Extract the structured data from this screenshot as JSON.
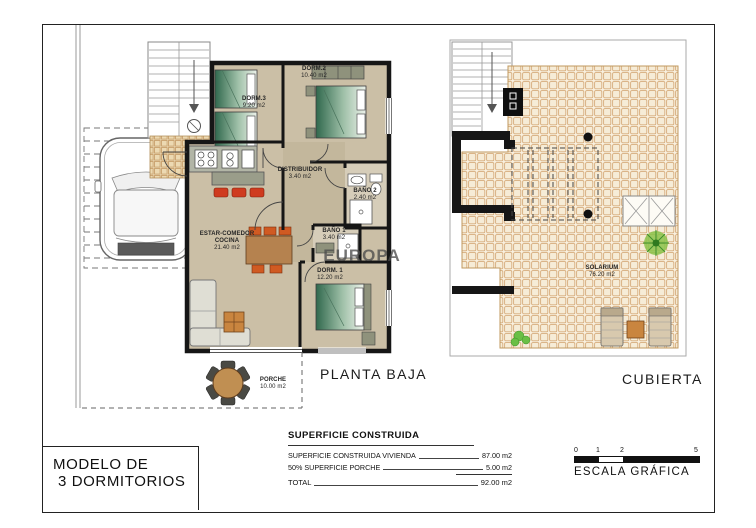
{
  "title_block": {
    "line1": "MODELO DE",
    "line2": "3 DORMITORIOS"
  },
  "watermark": "EUROPA",
  "plans": {
    "planta_baja": {
      "label": "PLANTA BAJA",
      "rooms": {
        "dorm3": {
          "name": "DORM.3",
          "area": "9.20 m2"
        },
        "dorm2": {
          "name": "DORM.2",
          "area": "10.40 m2"
        },
        "distribuidor": {
          "name": "DISTRIBUIDOR",
          "area": "3.40 m2"
        },
        "bano2": {
          "name": "BAÑO 2",
          "area": "2.40 m2"
        },
        "bano1": {
          "name": "BAÑO 1",
          "area": "3.40 m2"
        },
        "estar": {
          "name": "ESTAR-COMEDOR COCINA",
          "area": "21.40 m2"
        },
        "dorm1": {
          "name": "DORM. 1",
          "area": "12.20 m2"
        },
        "porche": {
          "name": "PORCHE",
          "area": "10.00 m2"
        }
      }
    },
    "cubierta": {
      "label": "CUBIERTA",
      "rooms": {
        "solarium": {
          "name": "SOLARIUM",
          "area": "76.20 m2"
        }
      }
    }
  },
  "summary": {
    "title": "SUPERFICIE CONSTRUIDA",
    "rows": [
      {
        "label": "SUPERFICIE CONSTRUIDA VIVIENDA",
        "value": "87.00 m2"
      },
      {
        "label": "50% SUPERFICIE PORCHE",
        "value": "5.00 m2"
      }
    ],
    "total": {
      "label": "TOTAL",
      "value": "92.00 m2"
    }
  },
  "scale_bar": {
    "label": "ESCALA GRÁFICA",
    "ticks": [
      "0",
      "1",
      "2",
      "5"
    ]
  },
  "colors": {
    "wall": "#161616",
    "room_floor": "#cbbfa6",
    "hall_floor": "#c3b79c",
    "roof_tile_grid": "#d6ac7c",
    "entry_tile_grid": "#c49a64",
    "bed_green": "#30684d",
    "stool_red": "#cf3b1f",
    "chair_orange": "#d05a22",
    "table_wood": "#b5824f",
    "plant_green": "#6abf45"
  }
}
